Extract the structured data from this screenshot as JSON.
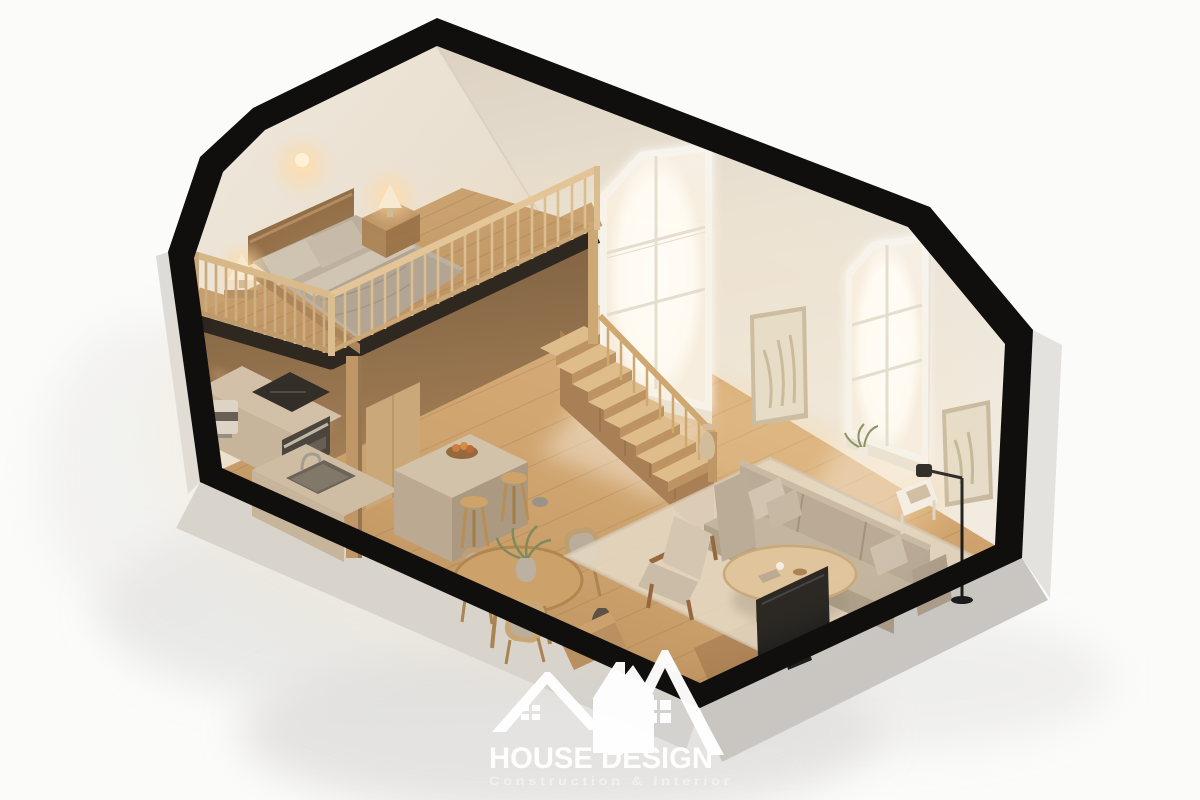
{
  "meta": {
    "description": "3D isometric dollhouse cutaway rendering of a small loft apartment interior",
    "render_style": "architectural visualization, gabled roof section cut open, white background"
  },
  "watermark": {
    "brand": "HOUSE DESIGN",
    "tagline": "Construction & Interior"
  },
  "palette": {
    "background": "#fbfbfa",
    "shell_black": "#100f0d",
    "slab_gray": "#c9c6c2",
    "slab_gray_light": "#d4d2ce",
    "outer_strip_gray": "#dedcd8",
    "soft_shadow": "#dedddb",
    "wall_cream": "#ece4d8",
    "wall_shaded": "#dcd2c3",
    "window_glow": "#ffffff",
    "window_frame": "#f7f4ee",
    "floor_wood": "#c99e6c",
    "floor_wood_dark": "#ad8050",
    "deck_wood": "#c0976a",
    "railing_wood": "#d6b686",
    "under_loft_wood": "#7d5c3c",
    "counter_stone": "#c0af99",
    "island_stone": "#cdbfa9",
    "bed_frame": "#8f6a44",
    "bedding": "#b5aa9c",
    "pillow": "#cac0b2",
    "sofa": "#b3a492",
    "rug": "#e3d9c9",
    "table_wood": "#c79a62",
    "tv_black": "#141414",
    "lamp_glow": "#ffd9a2",
    "art_paper": "#e5dcc8",
    "watermark_white": "#ffffff"
  },
  "scene": {
    "loft_bedroom": [
      "double-bed",
      "gray-bedding",
      "two-pillows",
      "wood-headboard",
      "nightstand",
      "bedside-lamp",
      "corner-lamp",
      "wood-spindle-railing",
      "wall-sconce-glow"
    ],
    "kitchen": [
      "stone-counter",
      "induction-cooktop",
      "built-in-oven",
      "sink-with-faucet",
      "espresso-machine",
      "tall-cabinet",
      "kitchen-island",
      "fruit-bowl",
      "bar-stools"
    ],
    "dining_area": [
      "round-wood-table",
      "potted-plant",
      "dining-chairs",
      "floor-vase"
    ],
    "living_room": [
      "beige-sofa",
      "throw-pillows",
      "oval-coffee-table",
      "television",
      "wood-bench",
      "lounge-armchair",
      "area-rug",
      "black-floor-lamp",
      "white-side-table",
      "books"
    ],
    "architecture": [
      "gabled-roof-cutaway-shell",
      "dormer-window-left",
      "dormer-window-right",
      "wood-staircase",
      "stair-railing",
      "loft-platform",
      "support-post",
      "wall-art-frame-1",
      "wall-art-frame-2",
      "plank-wood-floor",
      "windowsill-plant"
    ]
  }
}
